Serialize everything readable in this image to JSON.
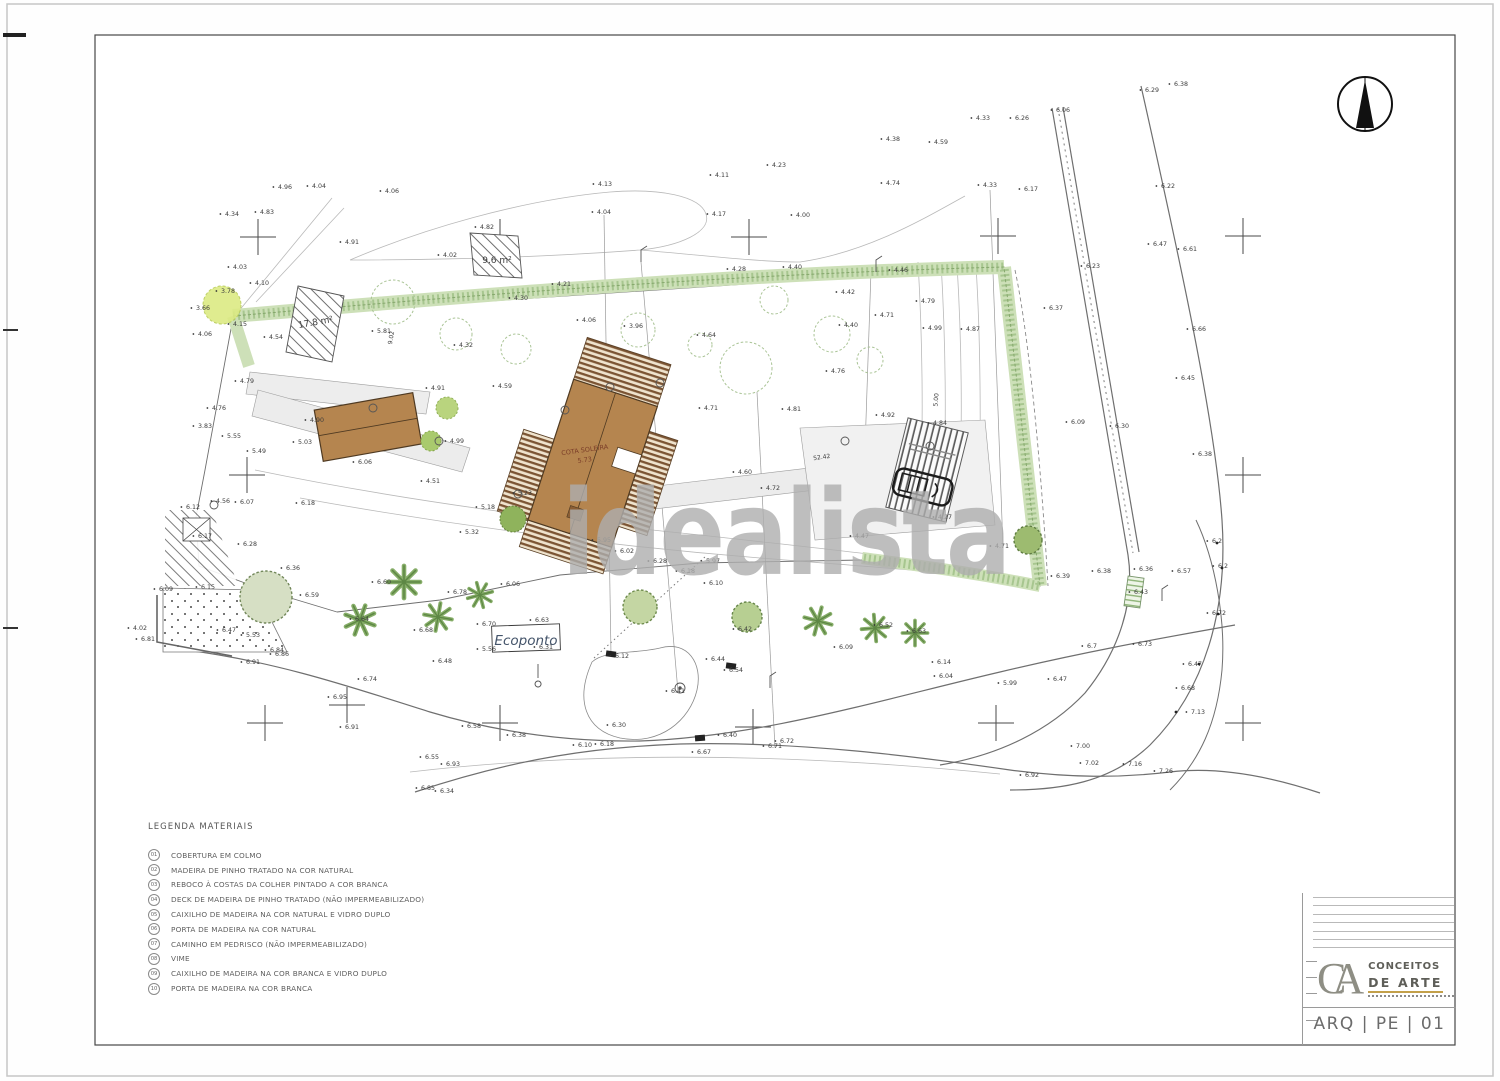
{
  "sheet": {
    "code": "ARQ | PE | 01",
    "brand": {
      "monogram": "CA",
      "line1": "CONCEITOS",
      "line2": "DE ARTE"
    },
    "watermark": "idealista"
  },
  "legend": {
    "title": "LEGENDA  MATERIAIS",
    "items": [
      {
        "num": "01",
        "label": "COBERTURA EM COLMO"
      },
      {
        "num": "02",
        "label": "MADEIRA DE PINHO TRATADO NA COR NATURAL"
      },
      {
        "num": "03",
        "label": "REBOCO À COSTAS DA COLHER PINTADO A COR BRANCA"
      },
      {
        "num": "04",
        "label": "DECK DE MADEIRA DE PINHO TRATADO (NÃO IMPERMEABILIZADO)"
      },
      {
        "num": "05",
        "label": "CAIXILHO DE MADEIRA NA COR NATURAL E VIDRO DUPLO"
      },
      {
        "num": "06",
        "label": "PORTA DE MADEIRA NA COR NATURAL"
      },
      {
        "num": "07",
        "label": "CAMINHO EM PEDRISCO (NÃO IMPERMEABILIZADO)"
      },
      {
        "num": "08",
        "label": "VIME"
      },
      {
        "num": "09",
        "label": "CAIXILHO DE MADEIRA NA COR BRANCA E VIDRO DUPLO"
      },
      {
        "num": "10",
        "label": "PORTA DE MADEIRA NA COR BRANCA"
      }
    ]
  },
  "plan": {
    "colors": {
      "building": "#b5854f",
      "deck_stripe": "#7b5433",
      "hedge": "#cde0b8",
      "tree": "#86ad68",
      "watermark": "#aeaeae",
      "gold": "#c3a04a"
    },
    "labels": [
      {
        "x": 497,
        "y": 263,
        "t": "9.6 m²",
        "s": 9
      },
      {
        "x": 316,
        "y": 325,
        "t": "17.8 m²",
        "s": 9,
        "r": -10
      },
      {
        "x": 585,
        "y": 452,
        "t": "COTA SOLEIRA",
        "s": 6.5,
        "c": "#7a3c28",
        "r": -8
      },
      {
        "x": 585,
        "y": 462,
        "t": "5.73",
        "s": 6.5,
        "c": "#7a3c28",
        "r": -8
      },
      {
        "x": 822,
        "y": 459,
        "t": "52.42",
        "s": 6,
        "r": -8
      },
      {
        "x": 938,
        "y": 400,
        "t": "5.00",
        "s": 6,
        "r": -85
      },
      {
        "x": 393,
        "y": 338,
        "t": "9.02",
        "s": 6,
        "r": -80
      },
      {
        "x": 526,
        "y": 645,
        "t": "Ecoponto",
        "s": 13.5,
        "c": "#44546a",
        "f": "serif",
        "i": 1
      }
    ],
    "spot_elevations": [
      [
        285,
        189,
        "4.96"
      ],
      [
        319,
        188,
        "4.04"
      ],
      [
        232,
        216,
        "4.34"
      ],
      [
        267,
        214,
        "4.83"
      ],
      [
        240,
        269,
        "4.03"
      ],
      [
        352,
        244,
        "4.91"
      ],
      [
        392,
        193,
        "4.06"
      ],
      [
        487,
        229,
        "4.82"
      ],
      [
        450,
        257,
        "4.02"
      ],
      [
        605,
        186,
        "4.13"
      ],
      [
        604,
        214,
        "4.04"
      ],
      [
        719,
        216,
        "4.17"
      ],
      [
        803,
        217,
        "4.00"
      ],
      [
        779,
        167,
        "4.23"
      ],
      [
        722,
        177,
        "4.11"
      ],
      [
        893,
        141,
        "4.38"
      ],
      [
        941,
        144,
        "4.59"
      ],
      [
        983,
        120,
        "4.33"
      ],
      [
        1022,
        120,
        "6.26"
      ],
      [
        1063,
        112,
        "6.06"
      ],
      [
        893,
        185,
        "4.74"
      ],
      [
        990,
        187,
        "4.33"
      ],
      [
        1031,
        191,
        "6.17"
      ],
      [
        1152,
        92,
        "6.29"
      ],
      [
        1181,
        86,
        "6.38"
      ],
      [
        1168,
        188,
        "6.22"
      ],
      [
        1160,
        246,
        "6.47"
      ],
      [
        1190,
        251,
        "6.61"
      ],
      [
        1093,
        268,
        "6.23"
      ],
      [
        1199,
        331,
        "6.66"
      ],
      [
        1188,
        380,
        "6.45"
      ],
      [
        1078,
        424,
        "6.09"
      ],
      [
        1122,
        428,
        "6.30"
      ],
      [
        1205,
        456,
        "6.38"
      ],
      [
        1056,
        310,
        "6.37"
      ],
      [
        739,
        271,
        "4.28"
      ],
      [
        795,
        269,
        "4.40"
      ],
      [
        901,
        272,
        "4.46"
      ],
      [
        848,
        294,
        "4.42"
      ],
      [
        851,
        327,
        "4.40"
      ],
      [
        887,
        317,
        "4.71"
      ],
      [
        935,
        330,
        "4.99"
      ],
      [
        973,
        331,
        "4.87"
      ],
      [
        928,
        303,
        "4.79"
      ],
      [
        838,
        373,
        "4.76"
      ],
      [
        709,
        337,
        "4.64"
      ],
      [
        636,
        328,
        "3.96"
      ],
      [
        589,
        322,
        "4.06"
      ],
      [
        564,
        286,
        "4.21"
      ],
      [
        521,
        300,
        "4.30"
      ],
      [
        384,
        333,
        "5.81"
      ],
      [
        466,
        347,
        "4.32"
      ],
      [
        505,
        388,
        "4.59"
      ],
      [
        711,
        410,
        "4.71"
      ],
      [
        794,
        411,
        "4.81"
      ],
      [
        203,
        310,
        "3.66"
      ],
      [
        228,
        293,
        "3.78"
      ],
      [
        262,
        285,
        "4.10"
      ],
      [
        240,
        326,
        "4.15"
      ],
      [
        276,
        339,
        "4.54"
      ],
      [
        205,
        336,
        "4.06"
      ],
      [
        247,
        383,
        "4.79"
      ],
      [
        219,
        410,
        "4.76"
      ],
      [
        234,
        438,
        "5.55"
      ],
      [
        259,
        453,
        "5.49"
      ],
      [
        305,
        444,
        "5.03"
      ],
      [
        317,
        422,
        "4.90"
      ],
      [
        365,
        464,
        "6.06"
      ],
      [
        205,
        428,
        "3.83"
      ],
      [
        438,
        390,
        "4.91"
      ],
      [
        457,
        443,
        "4.99"
      ],
      [
        433,
        483,
        "4.51"
      ],
      [
        525,
        495,
        "5.23"
      ],
      [
        488,
        509,
        "5.18"
      ],
      [
        472,
        534,
        "5.32"
      ],
      [
        604,
        542,
        "5.95"
      ],
      [
        627,
        553,
        "6.02"
      ],
      [
        688,
        573,
        "6.18"
      ],
      [
        713,
        563,
        "5.97"
      ],
      [
        716,
        585,
        "6.10"
      ],
      [
        660,
        563,
        "6.28"
      ],
      [
        745,
        474,
        "4.60"
      ],
      [
        773,
        490,
        "4.72"
      ],
      [
        888,
        417,
        "4.92"
      ],
      [
        940,
        425,
        "4.84"
      ],
      [
        945,
        519,
        "4.27"
      ],
      [
        862,
        538,
        "4.47"
      ],
      [
        1002,
        548,
        "4.71"
      ],
      [
        1063,
        578,
        "6.39"
      ],
      [
        1104,
        573,
        "6.38"
      ],
      [
        1146,
        571,
        "6.36"
      ],
      [
        1141,
        594,
        "6.43"
      ],
      [
        1184,
        573,
        "6.57"
      ],
      [
        1217,
        543,
        "6.2"
      ],
      [
        1223,
        568,
        "6.2"
      ],
      [
        1219,
        615,
        "6.72"
      ],
      [
        1195,
        666,
        "6.47"
      ],
      [
        1145,
        646,
        "6.73"
      ],
      [
        1188,
        690,
        "6.68"
      ],
      [
        1198,
        714,
        "7.13"
      ],
      [
        193,
        509,
        "6.12"
      ],
      [
        223,
        503,
        "4.56"
      ],
      [
        247,
        504,
        "6.07"
      ],
      [
        308,
        505,
        "6.18"
      ],
      [
        205,
        538,
        "6.17"
      ],
      [
        250,
        546,
        "6.28"
      ],
      [
        293,
        570,
        "6.36"
      ],
      [
        312,
        597,
        "6.59"
      ],
      [
        208,
        589,
        "6.15"
      ],
      [
        166,
        591,
        "6.09"
      ],
      [
        229,
        632,
        "6.47"
      ],
      [
        253,
        637,
        "5.53"
      ],
      [
        140,
        630,
        "4.02"
      ],
      [
        148,
        641,
        "6.81"
      ],
      [
        277,
        652,
        "6.84"
      ],
      [
        362,
        621,
        "6.64"
      ],
      [
        384,
        584,
        "6.60"
      ],
      [
        460,
        594,
        "6.78"
      ],
      [
        426,
        632,
        "6.68"
      ],
      [
        513,
        586,
        "6.06"
      ],
      [
        489,
        626,
        "6.70"
      ],
      [
        542,
        622,
        "6.63"
      ],
      [
        489,
        651,
        "5.56"
      ],
      [
        546,
        649,
        "6.31"
      ],
      [
        445,
        663,
        "6.48"
      ],
      [
        370,
        681,
        "6.74"
      ],
      [
        340,
        699,
        "6.95"
      ],
      [
        253,
        664,
        "6.91"
      ],
      [
        282,
        656,
        "6.86"
      ],
      [
        622,
        658,
        "6.12"
      ],
      [
        718,
        661,
        "6.44"
      ],
      [
        736,
        672,
        "6.54"
      ],
      [
        619,
        727,
        "6.30"
      ],
      [
        607,
        746,
        "6.18"
      ],
      [
        704,
        754,
        "6.67"
      ],
      [
        730,
        737,
        "6.40"
      ],
      [
        775,
        748,
        "6.71"
      ],
      [
        678,
        693,
        "6.41"
      ],
      [
        745,
        631,
        "6.42"
      ],
      [
        886,
        627,
        "6.52"
      ],
      [
        919,
        633,
        "6.63"
      ],
      [
        846,
        649,
        "6.09"
      ],
      [
        944,
        664,
        "6.14"
      ],
      [
        1010,
        685,
        "5.99"
      ],
      [
        1060,
        681,
        "6.47"
      ],
      [
        519,
        737,
        "6.38"
      ],
      [
        474,
        728,
        "6.58"
      ],
      [
        432,
        759,
        "6.55"
      ],
      [
        453,
        766,
        "6.93"
      ],
      [
        428,
        790,
        "6.85"
      ],
      [
        447,
        793,
        "6.34"
      ],
      [
        352,
        729,
        "6.91"
      ],
      [
        585,
        747,
        "6.10"
      ],
      [
        787,
        743,
        "6.72"
      ],
      [
        1092,
        648,
        "6.7"
      ],
      [
        1083,
        748,
        "7.00"
      ],
      [
        1092,
        765,
        "7.02"
      ],
      [
        1135,
        766,
        "7.16"
      ],
      [
        1166,
        773,
        "7.26"
      ],
      [
        1032,
        777,
        "6.92"
      ],
      [
        946,
        678,
        "6.04"
      ]
    ]
  }
}
